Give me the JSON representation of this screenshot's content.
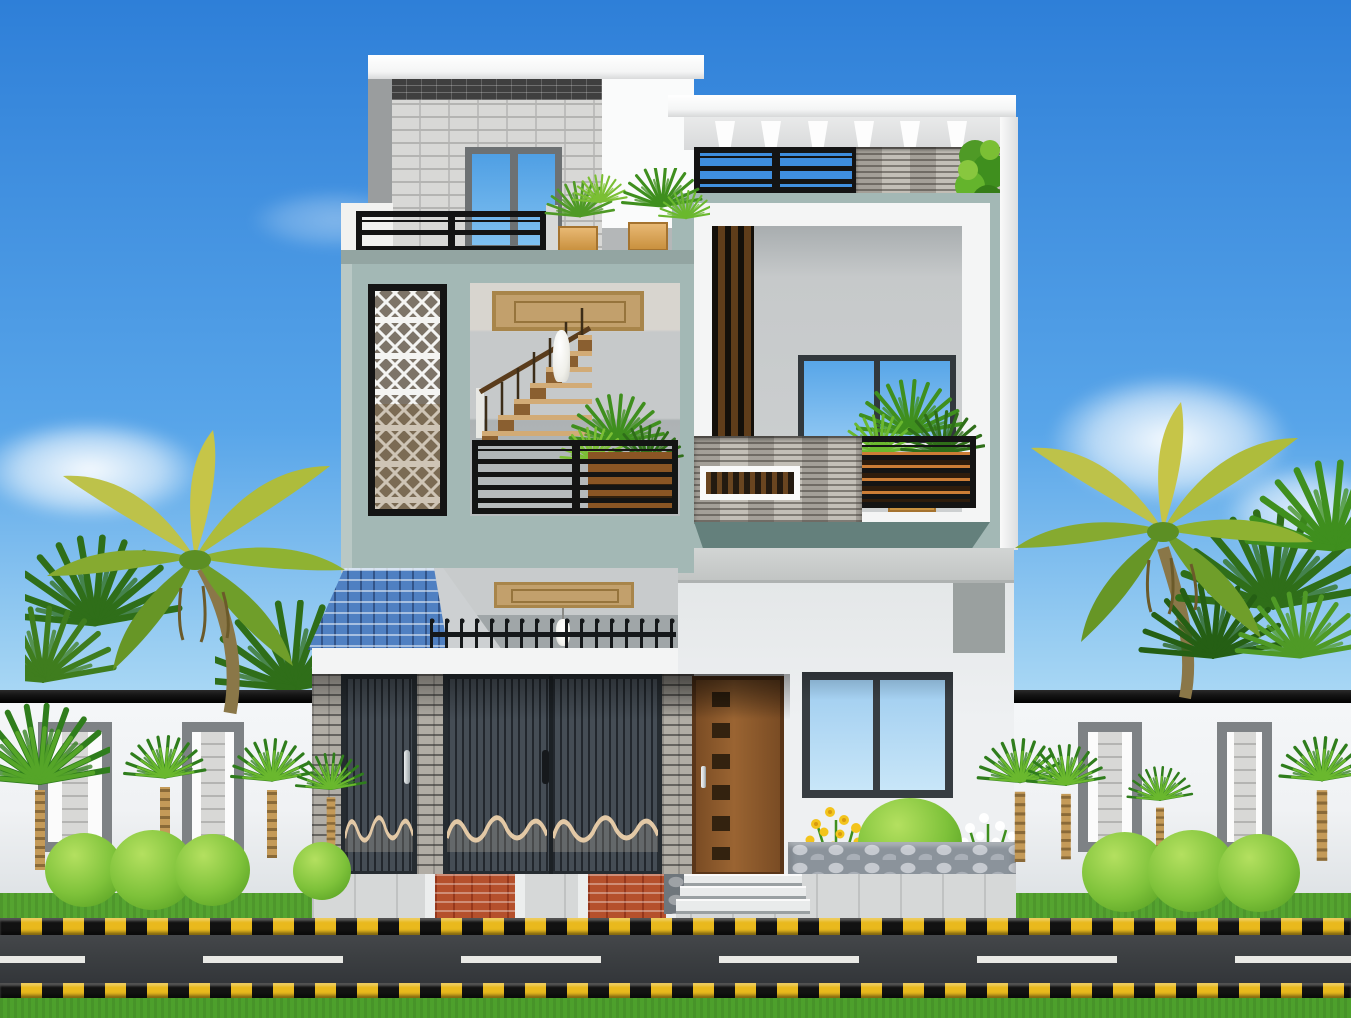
{
  "scene": {
    "description_objects": [
      "blue sky with clouds",
      "three-storey modern house render",
      "white roof slabs",
      "gray brick feature tower",
      "upper window with blue glazing",
      "roof terrace black railings",
      "wooden planter boxes with palms",
      "sage-teal facade walls",
      "white geometric jali lattice panel",
      "open balcony with interior staircase",
      "brown ceiling panels",
      "pendant lamp",
      "vertical wood slat screen",
      "stone cladding bands",
      "climbing vine",
      "blue tiled canopy roof",
      "black spear fence",
      "gray brick pillars",
      "two dark garage gates with wave motif",
      "brown wooden entrance door",
      "double ground-floor window",
      "stone flower bed with yellow and white flowers",
      "round garden bushes",
      "white compound walls with stone pilaster panels",
      "fan palms with shaggy trunks",
      "large yellow-green feather palms",
      "entrance steps",
      "paved driveway with red pavers",
      "yellow-black hazard curbs",
      "asphalt road with white lane dashes",
      "green grass verge"
    ]
  },
  "palette": {
    "sky_top": "#2e7fd8",
    "sky_mid": "#58a5e9",
    "sky_low": "#a8d7f4",
    "slab_white": "#f4f5f5",
    "wall_white": "#eef0f2",
    "mid_wall_white": "#fafbfb",
    "teal": "#a3b8b5",
    "teal_dark": "#93a5a2",
    "teal_shadow": "#64807c",
    "teal_edge": "#b9c8c5",
    "brick_light": "#d8d8d6",
    "brick_mortar": "#b4b4b2",
    "brick_band_dark": "#3f3f3f",
    "gray_strip": "#9a9d9e",
    "glass_blue": "#58a6e8",
    "glass_pale": "#b7dcf6",
    "frame_gray": "#6d7173",
    "frame_dark": "#32383c",
    "railing_black": "#141414",
    "post_white": "#f2f2f0",
    "planter_wood": "#dca45e",
    "planter_orange": "#cc7d36",
    "wood_slat": "#8a5524",
    "slat_screen_brown": "#5f3d1a",
    "interior_gray": "#c8cbcc",
    "interior_gray_dark": "#a0a6a8",
    "ceiling_tan": "#c2a06c",
    "ceiling_tan_dark": "#96743c",
    "stone_plank": "#c3bfb7",
    "roof_blue": "#4f80c2",
    "gable_gray": "#cdd0d2",
    "fence_black": "#15181a",
    "fascia_white": "#f3f4f4",
    "door_slate": "#454d55",
    "door_slate_dark": "#262c31",
    "wave_cream": "#e3c9a6",
    "pillar_brick": "#b1ada5",
    "door_brown": "#8a5a2e",
    "door_brown_dark": "#5a3619",
    "handle_silver": "#cfd4d6",
    "compound_white": "#f0f2f4",
    "coping": "#141414",
    "panel_frame": "#7e8285",
    "grass": "#55a430",
    "bush": "#7ec23a",
    "road": "#3b3e41",
    "road_line": "#e9e9e5",
    "curb_yellow": "#e9b91d",
    "cobble_base": "#8b939b",
    "cobble_hi": "#c6cad0",
    "paver_red": "#b5502c",
    "step_white": "#e9ebeb",
    "palm_dark": "#2f6e19",
    "palm_mid": "#4f9a26",
    "palm_light": "#7bbf34",
    "frond_yellow": "#c6c548",
    "trunk_tan": "#c49a58",
    "flower_yellow": "#f3c41c",
    "flower_white": "#ffffff",
    "statue_white": "#efefe9",
    "stairs_tread": "#d2ab76",
    "stairs_riser": "#8a5f30",
    "lamp_white": "#f4f4f0"
  }
}
